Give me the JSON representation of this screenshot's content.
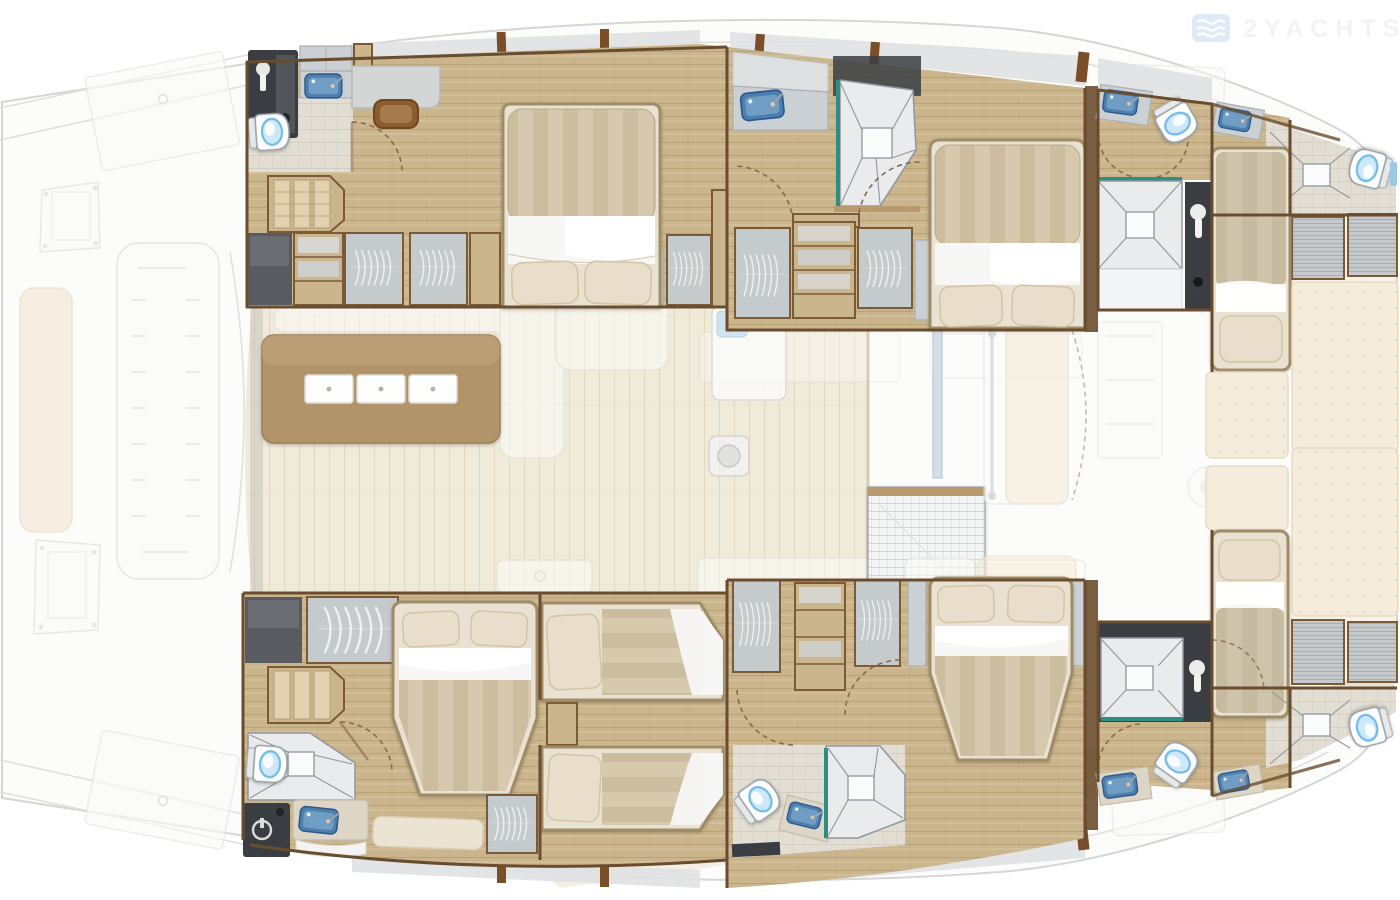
{
  "watermark": {
    "brand_text": "2YACHTS",
    "icon": "waves-logo-icon"
  },
  "palette": {
    "bg": "#ffffff",
    "hull_fill": "#fcfcfb",
    "hull_line": "#d6d6d4",
    "ghost_line": "#e1e0dd",
    "wood_floor": "#cab58c",
    "wood_floor_dark": "#ac9266",
    "wood_trim": "#7d5a36",
    "wall": "#6a4c2e",
    "salon_floor": "#f0ead9",
    "salon_floor_line": "#e2d8c2",
    "tile": "#e9ebec",
    "tile_line": "#8f979e",
    "tile_warm": "#e2ded3",
    "teal": "#2e8f7e",
    "dark_locker": "#3a3e42",
    "gray_cabinet": "#585c60",
    "wardrobe": "#c5cacd",
    "wardrobe_shade": "#9aa0a5",
    "counter": "#cbd0d4",
    "counter_cream": "#ddd5c6",
    "sink_blue": "#4d7fae",
    "sink_blue_deep": "#2a5a8c",
    "water_blue": "#cde9f9",
    "water_rim": "#6fbbe8",
    "mattress_a": "#d6c9ae",
    "mattress_b": "#cbbd9e",
    "bed_frame": "#e9e2d2",
    "bed_rim": "#a08d68",
    "sheet": "#f7f7f5",
    "pillow": "#e8decb",
    "pillow_line": "#d3c4a5",
    "table_brown": "#b2946a",
    "door_arc": "#8a6a4a",
    "band": "#e0e2e3",
    "divider_brown": "#7a4e28",
    "ghost_cream": "#f5ecdb",
    "ghost_cream_line": "#e7dcc4",
    "hull_band_tan": "#e5ddcd",
    "hull_band_cream": "#f1ece1",
    "brand_blue": "#d9e8f6",
    "brand_text_color": "#f1f3f5"
  }
}
